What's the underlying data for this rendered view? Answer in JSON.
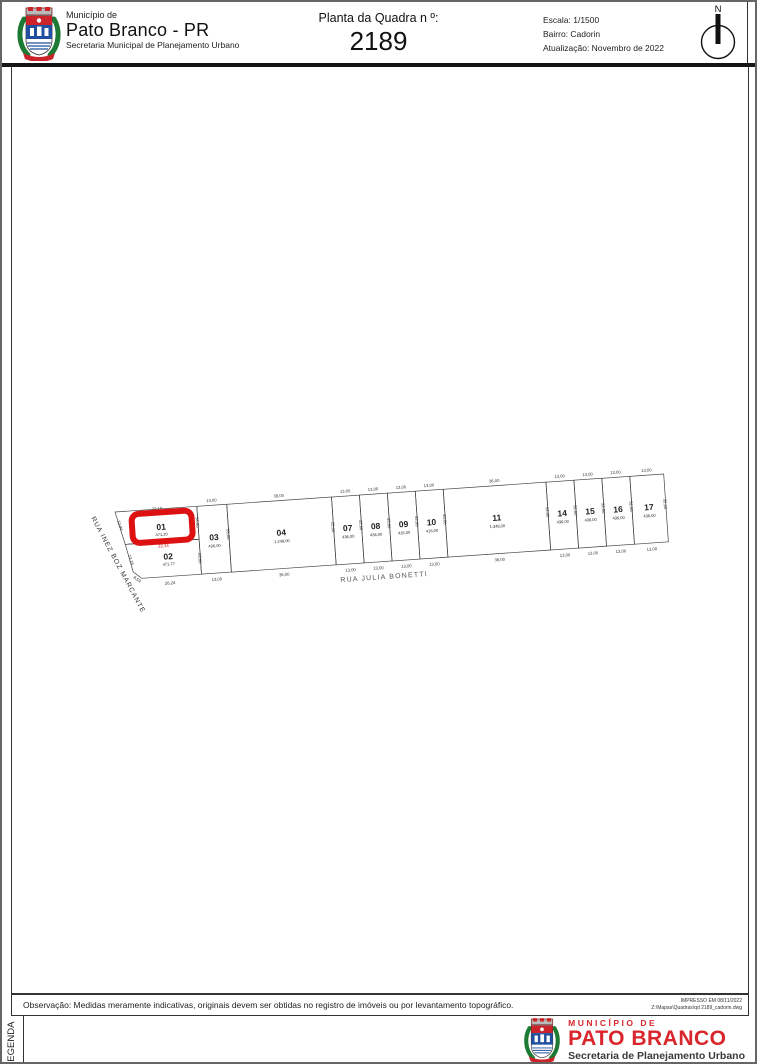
{
  "header": {
    "municipality_small": "Município de",
    "municipality": "Pato Branco - PR",
    "department": "Secretaria Municipal de Planejamento Urbano",
    "title": "Planta da Quadra n º:",
    "block_number": "2189",
    "scale": "Escala: 1/1500",
    "district": "Bairro: Cadorin",
    "updated": "Atualização: Novembro de 2022",
    "north_label": "N"
  },
  "map": {
    "streets": {
      "left": "RUA INEZ BOZ MARCANTE",
      "bottom": "RUA JULIA BONETTI"
    },
    "highlighted_lot": "01",
    "highlight_color": "#dd1111",
    "edge_dims": {
      "lot01_top": "22,10",
      "lot01_left": "12,94",
      "lot02_left": "13,16",
      "corner_chamfer": "8,59",
      "divider_01_02": "22,34",
      "lot02_bottom": "26,24"
    },
    "lots": [
      {
        "num": "01",
        "area": "471,20",
        "side": "33,00"
      },
      {
        "num": "02",
        "area": "471,77",
        "side": "33,00"
      },
      {
        "num": "03",
        "area": "436,00",
        "top": "13,00",
        "bottom": "13,00",
        "side": "33,00"
      },
      {
        "num": "04",
        "area": "1.248,00",
        "top": "39,00",
        "bottom": "36,00",
        "side": "32,00"
      },
      {
        "num": "07",
        "area": "436,00",
        "top": "13,00",
        "bottom": "13,00",
        "side": "32,00"
      },
      {
        "num": "08",
        "area": "436,00",
        "top": "13,00",
        "bottom": "13,00",
        "side": "33,00"
      },
      {
        "num": "09",
        "area": "416,00",
        "top": "13,00",
        "bottom": "13,00",
        "side": "33,00"
      },
      {
        "num": "10",
        "area": "416,00",
        "top": "13,00",
        "bottom": "13,00",
        "side": "33,00"
      },
      {
        "num": "11",
        "area": "1.348,00",
        "top": "36,00",
        "bottom": "36,00",
        "side": "32,00"
      },
      {
        "num": "14",
        "area": "436,00",
        "top": "13,00",
        "bottom": "13,00",
        "side": "32,00"
      },
      {
        "num": "15",
        "area": "436,00",
        "top": "13,00",
        "bottom": "13,00",
        "side": "32,00"
      },
      {
        "num": "16",
        "area": "436,00",
        "top": "13,00",
        "bottom": "13,00",
        "side": "32,00"
      },
      {
        "num": "17",
        "area": "436,00",
        "top": "13,00",
        "bottom": "13,00",
        "side": "32,00"
      }
    ]
  },
  "note": {
    "text": "Observação: Medidas meramente indicativas, originais devem ser obtidas no registro de imóveis ou por levantamento topográfico."
  },
  "print_info": {
    "line1": "IMPRESSO EM   08/11/2022",
    "line2": "Z:\\Mapas\\Quadras\\qd 2189_cadorin.dwg"
  },
  "legend_label": "LEGENDA",
  "footer_logo": {
    "line1": "MUNICÍPIO  DE",
    "line2": "PATO BRANCO",
    "line3": "Secretaria de Planejamento Urbano"
  }
}
